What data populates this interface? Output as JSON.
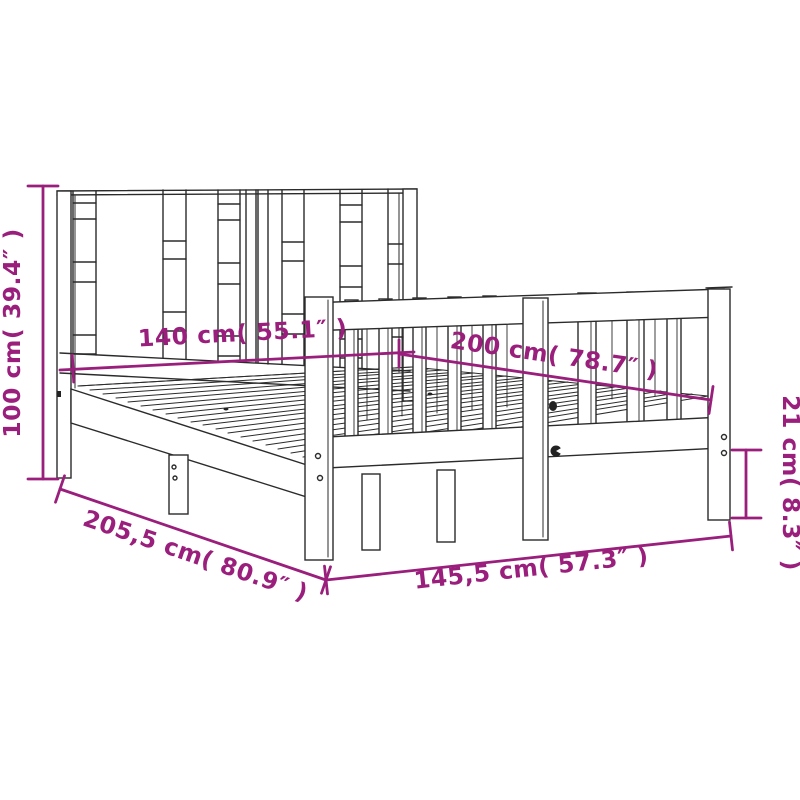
{
  "diagram": {
    "type": "product-dimension-diagram",
    "subject": "wooden bed frame with slatted headboard and spindle footboard",
    "dimensions": {
      "headboard_height": {
        "label": "100 cm( 39.4″ )",
        "cm": "100",
        "inches": "39.4",
        "orientation": "vertical-left"
      },
      "mattress_width": {
        "label": "140 cm( 55.1″ )",
        "cm": "140",
        "inches": "55.1",
        "orientation": "along-headboard"
      },
      "mattress_length": {
        "label": "200 cm( 78.7″ )",
        "cm": "200",
        "inches": "78.7",
        "orientation": "along-side-rail"
      },
      "frame_height": {
        "label": "21 cm( 8.3″ )",
        "cm": "21",
        "inches": "8.3",
        "orientation": "vertical-right"
      },
      "frame_length": {
        "label": "205,5 cm( 80.9″ )",
        "cm": "205,5",
        "inches": "80.9",
        "orientation": "bottom-left-diagonal"
      },
      "frame_width": {
        "label": "145,5 cm( 57.3″ )",
        "cm": "145,5",
        "inches": "57.3",
        "orientation": "bottom-front"
      }
    },
    "colors": {
      "dimension_color": "#9a1e7c",
      "line_art_color": "#2b2b2b",
      "background": "#ffffff"
    }
  }
}
